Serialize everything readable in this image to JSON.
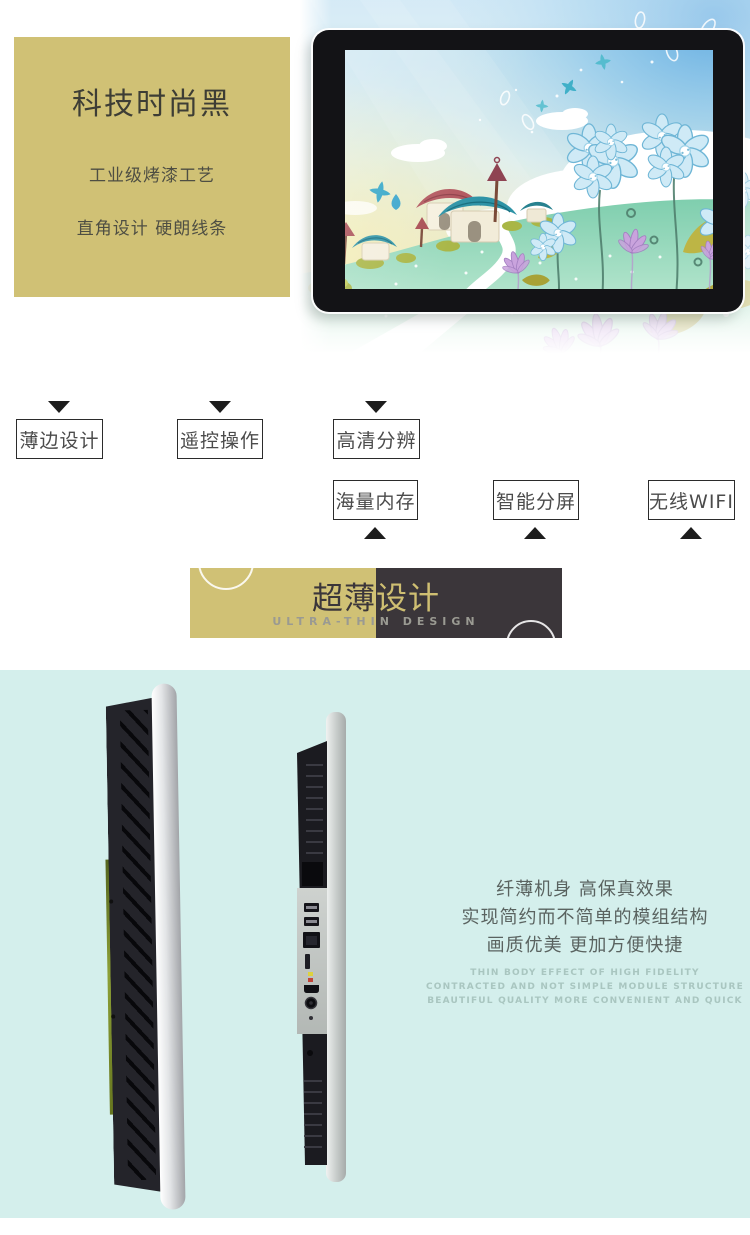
{
  "colors": {
    "khaki": "#d0c175",
    "banner_dark": "#3b363a",
    "mint": "#d4efec"
  },
  "hero_panel": {
    "title": "科技时尚黑",
    "line1": "工业级烤漆工艺",
    "line2": "直角设计 硬朗线条"
  },
  "features": {
    "row1": [
      "薄边设计",
      "遥控操作",
      "高清分辨"
    ],
    "row2": [
      "海量内存",
      "智能分屏",
      "无线WIFI"
    ]
  },
  "banner": {
    "title_part1": "超薄",
    "title_part2": "设计",
    "subtitle": "ULTRA-THIN DESIGN"
  },
  "thin_body": {
    "cn_lines": [
      "纤薄机身 高保真效果",
      "实现简约而不简单的模组结构",
      "画质优美 更加方便快捷"
    ],
    "en_lines": [
      "THIN BODY EFFECT OF HIGH FIDELITY",
      "CONTRACTED AND NOT SIMPLE MODULE STRUCTURE",
      "BEAUTIFUL QUALITY MORE CONVENIENT AND QUICK"
    ]
  }
}
